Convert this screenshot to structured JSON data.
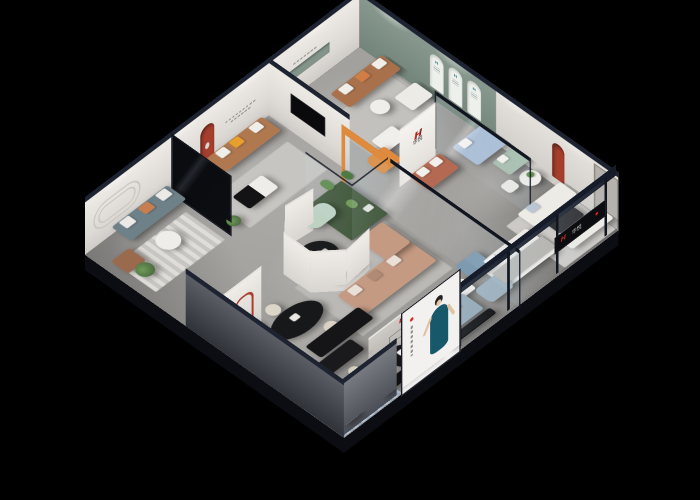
{
  "scene": {
    "title": "3D isometric cutaway render of a furniture showroom on black background"
  },
  "brand": {
    "initial": "H",
    "name": "华悦"
  },
  "signs": {
    "pillar_logo": "H",
    "pillar_name": "华悦",
    "storefront_sign_text": "华悦",
    "lowwall_sign_text": "华悦",
    "arch_certificate_mark": "H"
  },
  "palette": {
    "bg": "#000000",
    "navy": "#1d2330",
    "frame": "#10151f",
    "wall": "#e8e5e0",
    "floor": "#a3a19e",
    "green-wall": "#83948a",
    "accent-red": "#a63e2e",
    "brand-red": "#d8281e",
    "caramel": "#b0784f",
    "brown": "#a8714b",
    "teal-grey": "#6e8189",
    "tan": "#c49a83",
    "blue": "#a9bed6",
    "steel": "#93a7b5",
    "mint": "#bed2c4",
    "sage": "#a8bfae",
    "terracotta": "#b46a52",
    "orange": "#df8a3c",
    "cream": "#ddd6c8",
    "white-furn": "#edebe6",
    "black-furn": "#151517",
    "cactus": "#5d8a4a",
    "moss": "#41573a",
    "poster-dress": "#17586b",
    "ext-wall": "#5d6067"
  },
  "rooms": [
    {
      "name": "lounge-arc-wall",
      "items": "teal-grey sofa, round table, leather armchair, striped rug, plants"
    },
    {
      "name": "caramel-sofa-room",
      "items": "caramel leather sofa, red arched niche, black-white coffee table"
    },
    {
      "name": "top-living-room",
      "items": "brown leather sofa, white armchair, statue, orange lounge chair, green wall niche"
    },
    {
      "name": "green-arch-gallery",
      "items": "sage green wall with three white arches, blue sofa, sage loveseat, dining set"
    },
    {
      "name": "white-sofa-showroom",
      "items": "facing white sofas, red arch niche, door, storefront sign, daybed"
    },
    {
      "name": "center-display",
      "items": "curved white partition, black oval table, mint bench, tan sectional, cactus terrarium"
    },
    {
      "name": "front-showroom",
      "items": "dining table with cream chairs, bar stools, steel-blue sofa, black benches, white corner sofa, brand low wall, poster panel"
    }
  ]
}
